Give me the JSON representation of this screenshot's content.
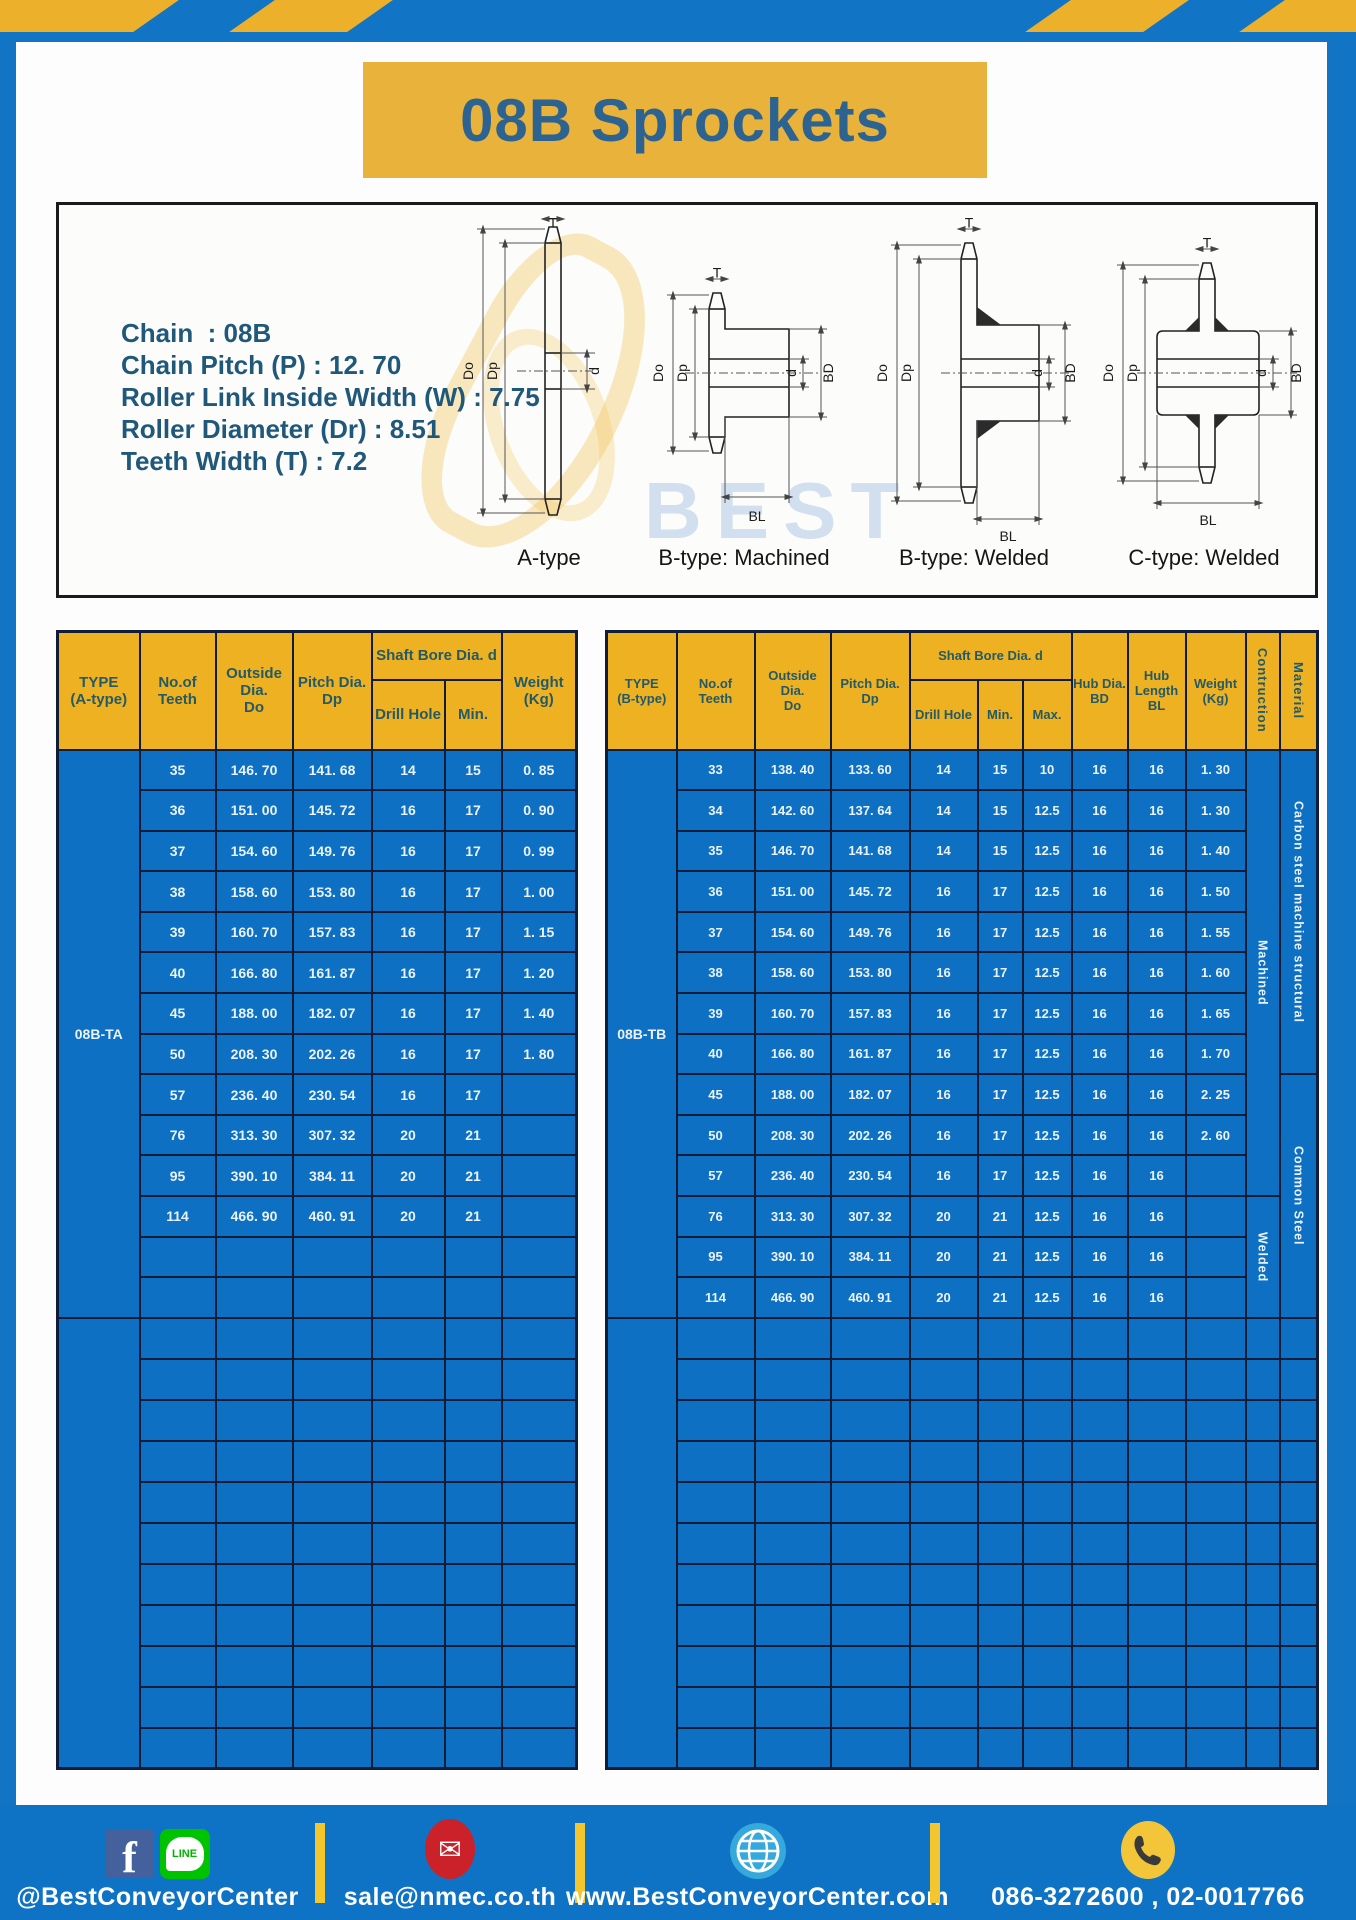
{
  "colors": {
    "frame": "#1274c5",
    "hazard": "#edb02a",
    "banner": "#e9b23a",
    "title": "#2d6391",
    "hdryellow": "#eeb121",
    "teal": "#235a66",
    "blue": "#0e70c2",
    "grid": "#101d38",
    "spec": "#20587a",
    "footerblue": "#0e73c5",
    "sep": "#f3c62e"
  },
  "page_title": "08B Sprockets",
  "specs": {
    "sep": " : ",
    "items": [
      {
        "label": "Chain ",
        "value": "08B"
      },
      {
        "label": "Chain Pitch (P)",
        "value": "12. 70"
      },
      {
        "label": "Roller Link Inside Width (W)",
        "value": "7.75"
      },
      {
        "label": "Roller Diameter (Dr)",
        "value": "8.51"
      },
      {
        "label": "Teeth Width (T)",
        "value": "7.2"
      }
    ]
  },
  "diagram": {
    "watermark": {
      "line1": "BEST",
      "line2": "CONVEYOR",
      "line3": "CENTER"
    },
    "dims": {
      "t": "T",
      "outside": "Do",
      "pitch": "Dp",
      "bore": "d",
      "hub_dia": "BD",
      "hub_len": "BL"
    },
    "figures": [
      {
        "caption": "A-type"
      },
      {
        "caption": "B-type: Machined"
      },
      {
        "caption": "B-type: Welded"
      },
      {
        "caption": "C-type: Welded"
      }
    ]
  },
  "table_a": {
    "headers": {
      "type": "TYPE\n(A-type)",
      "teeth": "No.of\nTeeth",
      "outside": "Outside\nDia.\nDo",
      "pitch": "Pitch Dia.\nDp",
      "shaft_bore": "Shaft Bore Dia. d",
      "drill": "Drill Hole",
      "min": "Min.",
      "weight": "Weight\n(Kg)"
    },
    "type_label": "08B-TA",
    "rows": [
      [
        "35",
        "146. 70",
        "141. 68",
        "14",
        "15",
        "0. 85"
      ],
      [
        "36",
        "151. 00",
        "145. 72",
        "16",
        "17",
        "0. 90"
      ],
      [
        "37",
        "154. 60",
        "149. 76",
        "16",
        "17",
        "0. 99"
      ],
      [
        "38",
        "158. 60",
        "153. 80",
        "16",
        "17",
        "1. 00"
      ],
      [
        "39",
        "160. 70",
        "157. 83",
        "16",
        "17",
        "1. 15"
      ],
      [
        "40",
        "166. 80",
        "161. 87",
        "16",
        "17",
        "1. 20"
      ],
      [
        "45",
        "188. 00",
        "182. 07",
        "16",
        "17",
        "1. 40"
      ],
      [
        "50",
        "208. 30",
        "202. 26",
        "16",
        "17",
        "1. 80"
      ],
      [
        "57",
        "236. 40",
        "230. 54",
        "16",
        "17",
        ""
      ],
      [
        "76",
        "313. 30",
        "307. 32",
        "20",
        "21",
        ""
      ],
      [
        "95",
        "390. 10",
        "384. 11",
        "20",
        "21",
        ""
      ],
      [
        "114",
        "466. 90",
        "460. 91",
        "20",
        "21",
        ""
      ]
    ],
    "block1_empty_rows": 2,
    "block2_rows": 11
  },
  "table_b": {
    "headers": {
      "type": "TYPE\n(B-type)",
      "teeth": "No.of\nTeeth",
      "outside": "Outside\nDia.\nDo",
      "pitch": "Pitch Dia.\nDp",
      "shaft_bore": "Shaft Bore Dia. d",
      "drill": "Drill Hole",
      "min": "Min.",
      "max": "Max.",
      "hub_dia": "Hub Dia.\nBD",
      "hub_len": "Hub\nLength\nBL",
      "weight": "Weight\n(Kg)",
      "construction": "Contruction",
      "material": "Material"
    },
    "type_label": "08B-TB",
    "rows": [
      [
        "33",
        "138. 40",
        "133. 60",
        "14",
        "15",
        "10",
        "16",
        "16",
        "1. 30"
      ],
      [
        "34",
        "142. 60",
        "137. 64",
        "14",
        "15",
        "12.5",
        "16",
        "16",
        "1. 30"
      ],
      [
        "35",
        "146. 70",
        "141. 68",
        "14",
        "15",
        "12.5",
        "16",
        "16",
        "1. 40"
      ],
      [
        "36",
        "151. 00",
        "145. 72",
        "16",
        "17",
        "12.5",
        "16",
        "16",
        "1. 50"
      ],
      [
        "37",
        "154. 60",
        "149. 76",
        "16",
        "17",
        "12.5",
        "16",
        "16",
        "1. 55"
      ],
      [
        "38",
        "158. 60",
        "153. 80",
        "16",
        "17",
        "12.5",
        "16",
        "16",
        "1. 60"
      ],
      [
        "39",
        "160. 70",
        "157. 83",
        "16",
        "17",
        "12.5",
        "16",
        "16",
        "1. 65"
      ],
      [
        "40",
        "166. 80",
        "161. 87",
        "16",
        "17",
        "12.5",
        "16",
        "16",
        "1. 70"
      ],
      [
        "45",
        "188. 00",
        "182. 07",
        "16",
        "17",
        "12.5",
        "16",
        "16",
        "2. 25"
      ],
      [
        "50",
        "208. 30",
        "202. 26",
        "16",
        "17",
        "12.5",
        "16",
        "16",
        "2. 60"
      ],
      [
        "57",
        "236. 40",
        "230. 54",
        "16",
        "17",
        "12.5",
        "16",
        "16",
        ""
      ],
      [
        "76",
        "313. 30",
        "307. 32",
        "20",
        "21",
        "12.5",
        "16",
        "16",
        ""
      ],
      [
        "95",
        "390. 10",
        "384. 11",
        "20",
        "21",
        "12.5",
        "16",
        "16",
        ""
      ],
      [
        "114",
        "466. 90",
        "460. 91",
        "20",
        "21",
        "12.5",
        "16",
        "16",
        ""
      ]
    ],
    "construction": [
      {
        "label": "Machined",
        "start": 0,
        "rowspan": 11
      },
      {
        "label": "Welded",
        "start": 11,
        "rowspan": 3
      }
    ],
    "material": [
      {
        "label": "Carbon steel  machine structural",
        "start": 0,
        "rowspan": 8
      },
      {
        "label": "Common Steel",
        "start": 8,
        "rowspan": 6
      }
    ],
    "block2_rows": 11
  },
  "footer": {
    "social_handle": "@BestConveyorCenter",
    "email": "sale@nmec.co.th",
    "website": "www.BestConveyorCenter.com",
    "phone": "086-3272600 , 02-0017766",
    "line_bubble_text": "LINE",
    "facebook_letter": "f",
    "mail_glyph": "✉"
  }
}
